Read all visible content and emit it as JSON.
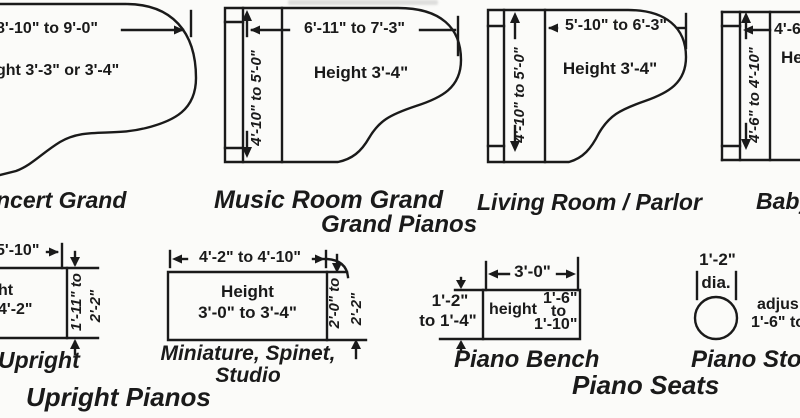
{
  "categories": {
    "grand": "Grand Pianos",
    "upright": "Upright Pianos",
    "seats": "Piano Seats"
  },
  "pianos": {
    "concert_grand": {
      "label": "ncert Grand",
      "length": "8'-10\" to 9'-0\"",
      "height": "ght  3'-3\" or 3'-4\""
    },
    "music_room_grand": {
      "label": "Music Room Grand",
      "length": "6'-11\" to 7'-3\"",
      "width": "4'-10\" to 5'-0\"",
      "height": "Height  3'-4\""
    },
    "living_room_parlor": {
      "label": "Living Room / Parlor",
      "length": "5'-10\" to 6'-3\"",
      "width": "4'-10\" to 5'-0\"",
      "height": "Height  3'-4\""
    },
    "baby_grand": {
      "label": "Baby",
      "length": "4'-6",
      "width": "4'-6\" to 4'-10\"",
      "height": "He"
    },
    "upright": {
      "label": "Upright",
      "length": "5'-10\"",
      "height_line1": "ht",
      "height_line2": "4'-2\"",
      "depth_line1": "1'-11\" to",
      "depth_line2": "2'-2\""
    },
    "miniature_spinet_studio": {
      "label_line1": "Miniature, Spinet,",
      "label_line2": "Studio",
      "length": "4'-2\" to 4'-10\"",
      "height_line1": "Height",
      "height_line2": "3'-0\" to 3'-4\"",
      "depth_line1": "2'-0\" to",
      "depth_line2": "2'-2\""
    }
  },
  "seats": {
    "bench": {
      "label": "Piano  Bench",
      "length": "3'-0\"",
      "depth_line1": "1'-2\"",
      "depth_line2": "to 1'-4\"",
      "height_word": "height",
      "height_line1": "1'-6\"",
      "height_line2": "to",
      "height_line3": "1'-10\""
    },
    "stool": {
      "label": "Piano Stoo",
      "diameter": "1'-2\"",
      "diameter_unit": "dia.",
      "note_line1": "adjus",
      "note_line2": "1'-6\" to"
    }
  }
}
